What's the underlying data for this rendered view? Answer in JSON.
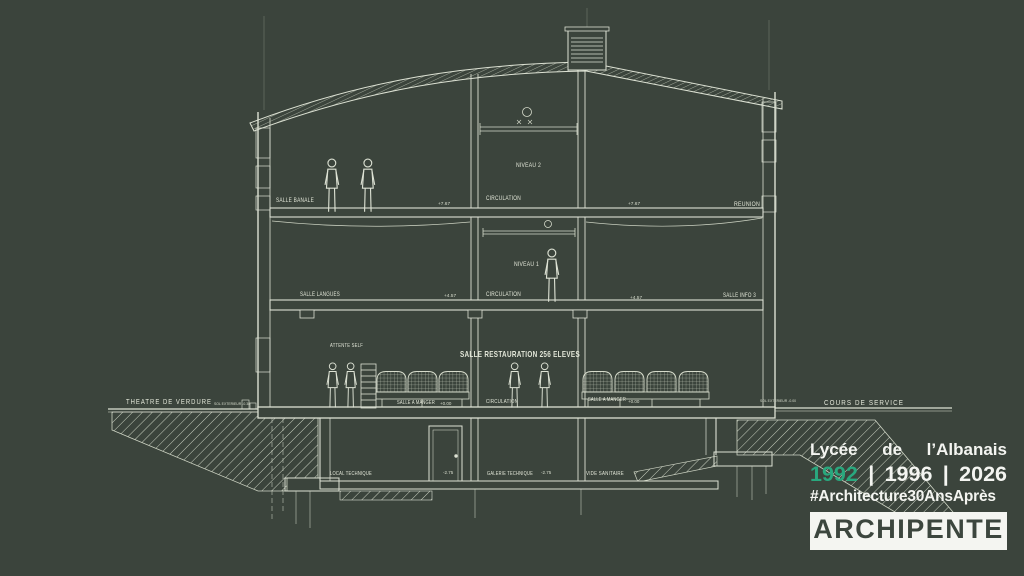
{
  "canvas": {
    "background": "#3b443c",
    "ink": "#dde2d4"
  },
  "drawing": {
    "rooms": {
      "salle_banale": "SALLE BANALE",
      "niveau_2": "NIVEAU 2",
      "circulation": "CIRCULATION",
      "reunion": "REUNION",
      "salle_langues": "SALLE LANGUES",
      "niveau_1": "NIVEAU 1",
      "salle_info_3": "SALLE INFO 3",
      "attente_self": "ATTENTE SELF",
      "salle_restauration": "SALLE RESTAURATION 256 ELEVES",
      "salle_a_manger": "SALLE A MANGER",
      "local_technique": "LOCAL TECHNIQUE",
      "galerie_technique": "GALERIE TECHNIQUE",
      "vide_sanitaire": "VIDE SANITAIRE"
    },
    "site": {
      "theatre_de_verdure": "THEATRE DE VERDURE",
      "sol_exterieur_left": "SOL EXTERIEUR -0.38",
      "sol_exterieur_right": "SOL EXTERIEUR -0.00",
      "cours_de_service": "COURS DE SERVICE"
    },
    "levels": {
      "niveau_2": "+7.67",
      "niveau_1": "+4.57",
      "rdc": "+0.00",
      "sous_sol": "-2.75"
    }
  },
  "branding": {
    "project": {
      "word1": "Lycée",
      "word2": "de",
      "word3": "l’Albanais"
    },
    "years": {
      "y1": "1992",
      "y2": "1996",
      "y3": "2026",
      "separator": "|"
    },
    "hashtag": "#Architecture30AnsAprès",
    "logo": "ARCHIPENTE",
    "colors": {
      "accent": "#29a87e",
      "text": "#f4f5f1",
      "logo_text": "#3c463e",
      "logo_bg": "#f4f5f1"
    }
  }
}
